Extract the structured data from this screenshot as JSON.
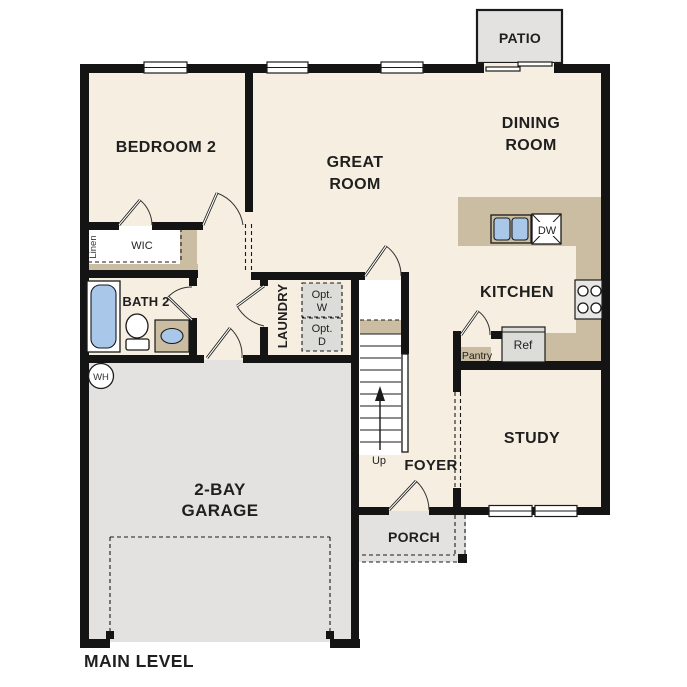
{
  "plan": {
    "title": "MAIN LEVEL",
    "rooms": {
      "patio": "PATIO",
      "bedroom2": "BEDROOM 2",
      "great_room": [
        "GREAT",
        "ROOM"
      ],
      "dining_room": [
        "DINING",
        "ROOM"
      ],
      "kitchen": "KITCHEN",
      "study": "STUDY",
      "foyer": "FOYER",
      "porch": "PORCH",
      "garage": [
        "2-BAY",
        "GARAGE"
      ],
      "laundry": "LAUNDRY",
      "bath2": "BATH 2",
      "wic": "WIC",
      "linen": "Linen",
      "pantry": "Pantry"
    },
    "fixtures": {
      "dishwasher": "DW",
      "refrigerator": "Ref",
      "water_heater": "WH",
      "stairs_direction": "Up",
      "opt_washer": [
        "Opt.",
        "W"
      ],
      "opt_dryer": [
        "Opt.",
        "D"
      ]
    },
    "colors": {
      "floor": "#f6eee0",
      "counter": "#cbbda1",
      "concrete": "#e3e2e0",
      "wall": "#141414",
      "fixture_blue": "#a9c7e8",
      "appliance": "#dcddd9",
      "text": "#1f1f1f"
    }
  }
}
